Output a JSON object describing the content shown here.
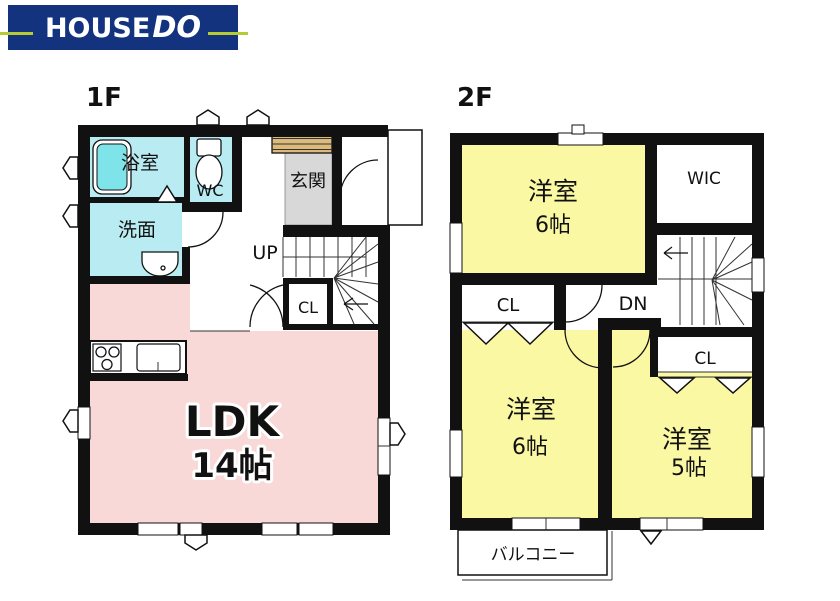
{
  "logo": {
    "house": "HOUSE",
    "do": "DO",
    "background": "#14337f",
    "accent_green": "#b5cc34",
    "text_color": "#ffffff"
  },
  "floor_1f": {
    "title": "1F",
    "rooms": {
      "bathroom": "浴室",
      "toilet": "WC",
      "washroom": "洗面",
      "entrance": "玄関",
      "stairs_up": "UP",
      "closet": "CL",
      "ldk": "LDK",
      "ldk_size": "14帖"
    },
    "colors": {
      "wet_room": "#b8ecf2",
      "bathtub": "#7fe4ea",
      "entrance_floor": "#d8d8d8",
      "shoe_cabinet": "#dcba7a",
      "ldk": "#f9d8d8"
    }
  },
  "floor_2f": {
    "title": "2F",
    "rooms": {
      "bedroom_north": "洋室",
      "bedroom_north_size": "6帖",
      "wic": "WIC",
      "closet_west": "CL",
      "stairs_down": "DN",
      "closet_east": "CL",
      "bedroom_sw": "洋室",
      "bedroom_sw_size": "6帖",
      "bedroom_se": "洋室",
      "bedroom_se_size": "5帖",
      "balcony": "バルコニー"
    },
    "colors": {
      "bedroom": "#fbf8a3"
    }
  }
}
